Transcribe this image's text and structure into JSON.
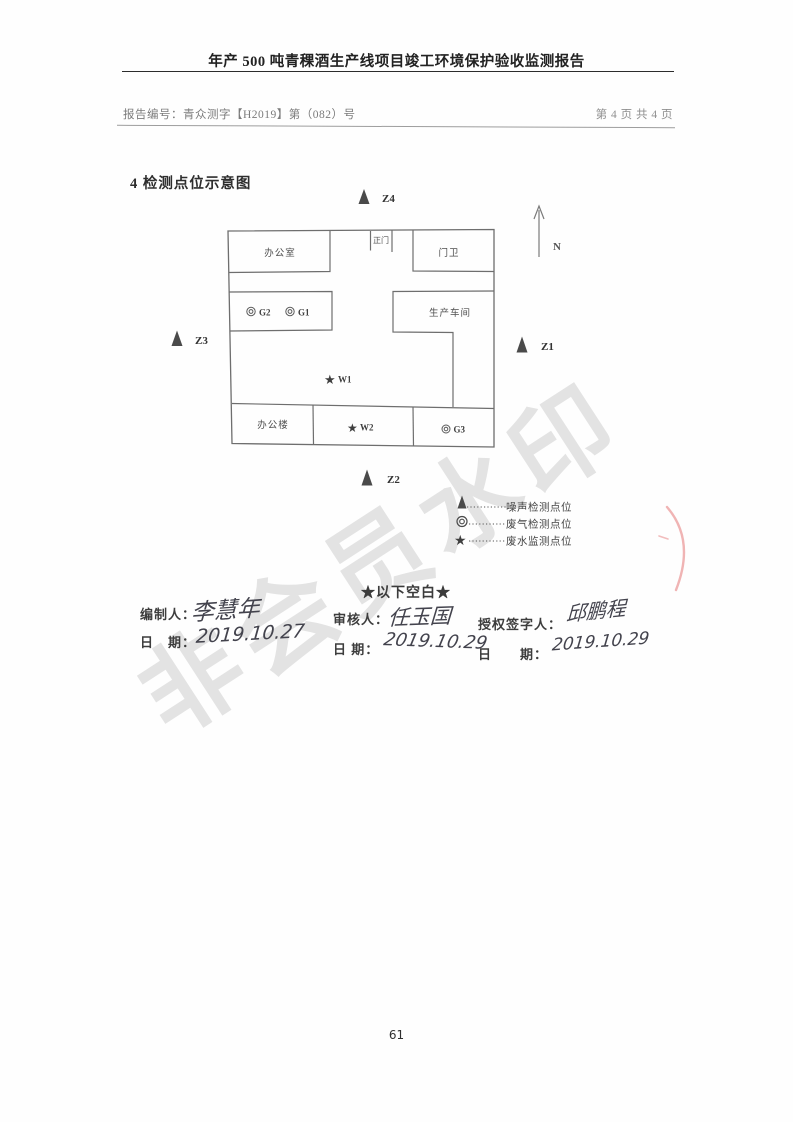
{
  "header": {
    "title": "年产 500 吨青稞酒生产线项目竣工环境保护验收监测报告",
    "report_no": "报告编号：青众测字【H2019】第（082）号",
    "page_indicator": "第 4 页 共 4 页"
  },
  "section": {
    "title": "4 检测点位示意图"
  },
  "diagram": {
    "north_label": "N",
    "rooms": {
      "office_room": "办公室",
      "main_gate": "正门",
      "guard_room": "门卫",
      "workshop": "生产车间",
      "office_building": "办公楼"
    },
    "points": {
      "z1": "Z1",
      "z2": "Z2",
      "z3": "Z3",
      "z4": "Z4",
      "g1": "G1",
      "g2": "G2",
      "g3": "G3",
      "w1": "W1",
      "w2": "W2"
    },
    "icons": {
      "noise": "▲",
      "gas": "◎",
      "water": "★"
    }
  },
  "legend": {
    "items": [
      {
        "symbol": "noise-triangle",
        "label": "噪声检测点位"
      },
      {
        "symbol": "gas-double-circle",
        "label": "废气检测点位"
      },
      {
        "symbol": "water-star",
        "label": "废水监测点位"
      }
    ]
  },
  "body": {
    "blank_note": "★以下空白★"
  },
  "signatures": {
    "preparer": {
      "label": "编制人：",
      "name": "李慧年",
      "date_label": "日　期：",
      "date": "2019.10.27"
    },
    "reviewer": {
      "label": "审核人：",
      "name": "任玉国",
      "date_label": "日 期：",
      "date": "2019.10.29"
    },
    "authorizer": {
      "label": "授权签字人：",
      "name": "邱鹏程",
      "date_label": "日　　期：",
      "date": "2019.10.29"
    }
  },
  "footer": {
    "page_number": "61"
  },
  "watermark": {
    "text": "非会员水印"
  }
}
